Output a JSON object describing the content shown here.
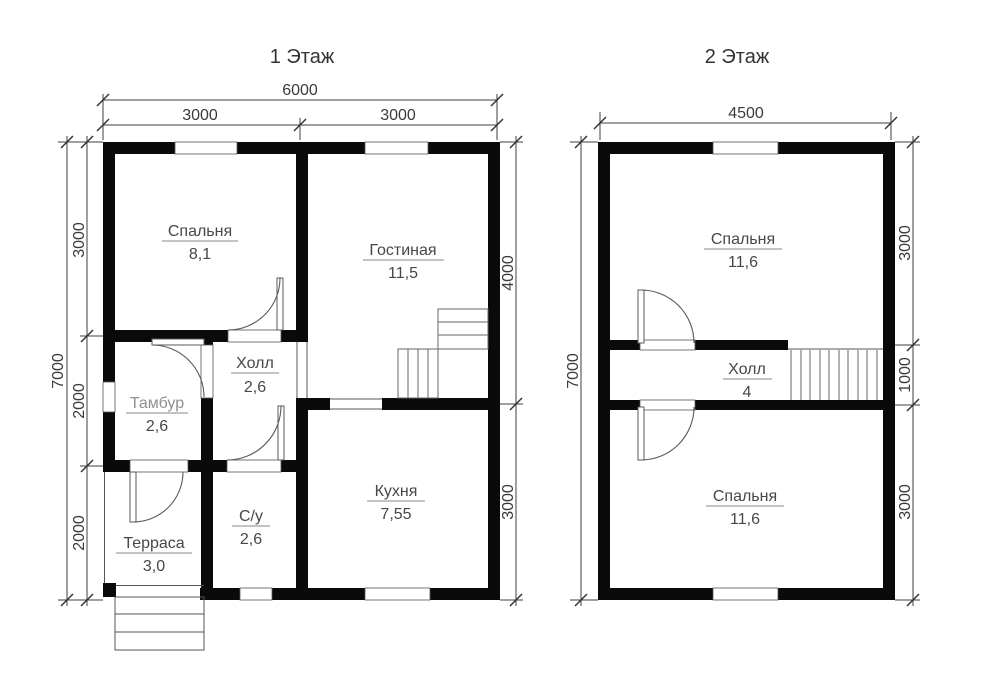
{
  "floor1": {
    "title": "1 Этаж",
    "rooms": [
      {
        "name": "Спальня",
        "area": "8,1"
      },
      {
        "name": "Гостиная",
        "area": "11,5"
      },
      {
        "name": "Тамбур",
        "area": "2,6"
      },
      {
        "name": "Холл",
        "area": "2,6"
      },
      {
        "name": "Терраса",
        "area": "3,0"
      },
      {
        "name": "С/у",
        "area": "2,6"
      },
      {
        "name": "Кухня",
        "area": "7,55"
      }
    ],
    "dims": {
      "width_total": "6000",
      "width_left": "3000",
      "width_right": "3000",
      "height_total": "7000",
      "left_top": "3000",
      "left_mid": "2000",
      "left_bottom": "2000",
      "right_top": "4000",
      "right_bottom": "3000"
    }
  },
  "floor2": {
    "title": "2 Этаж",
    "rooms": [
      {
        "name": "Спальня",
        "area": "11,6"
      },
      {
        "name": "Холл",
        "area": "4"
      },
      {
        "name": "Спальня",
        "area": "11,6"
      }
    ],
    "dims": {
      "width_total": "4500",
      "height_total": "7000",
      "right_top": "3000",
      "right_mid": "1000",
      "right_bottom": "3000"
    }
  },
  "colors": {
    "wall": "#0a0a0a",
    "dim_line": "#3f3f3f",
    "text": "#474747",
    "muted_text": "#8f8f8f"
  }
}
